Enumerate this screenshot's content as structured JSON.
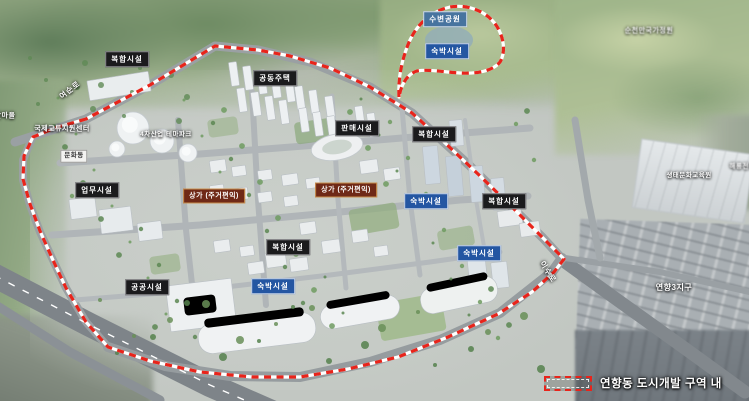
{
  "map": {
    "title": "연향동 도시개발 조감도",
    "labels": [
      {
        "name": "label-mixed-use-nw",
        "text": "복합시설",
        "type": "dark",
        "x": 127,
        "y": 59
      },
      {
        "name": "label-apartments",
        "text": "공동주택",
        "type": "dark",
        "x": 275,
        "y": 78
      },
      {
        "name": "label-retail",
        "text": "판매시설",
        "type": "dark",
        "x": 357,
        "y": 128
      },
      {
        "name": "label-mixed-use-ne",
        "text": "복합시설",
        "type": "dark",
        "x": 434,
        "y": 134
      },
      {
        "name": "label-office",
        "text": "업무시설",
        "type": "dark",
        "x": 97,
        "y": 190
      },
      {
        "name": "label-mixed-use-center",
        "text": "복합시설",
        "type": "dark",
        "x": 288,
        "y": 247
      },
      {
        "name": "label-mixed-use-east",
        "text": "복합시설",
        "type": "dark",
        "x": 504,
        "y": 201
      },
      {
        "name": "label-public-facility",
        "text": "공공시설",
        "type": "dark",
        "x": 147,
        "y": 287
      },
      {
        "name": "label-waterside-park",
        "text": "수변공원",
        "type": "park",
        "x": 445,
        "y": 19
      },
      {
        "name": "label-lodging-north",
        "text": "숙박시설",
        "type": "blue",
        "x": 447,
        "y": 51
      },
      {
        "name": "label-lodging-mid",
        "text": "숙박시설",
        "type": "blue",
        "x": 426,
        "y": 201
      },
      {
        "name": "label-lodging-southeast",
        "text": "숙박시설",
        "type": "blue",
        "x": 479,
        "y": 253
      },
      {
        "name": "label-lodging-south",
        "text": "숙박시설",
        "type": "blue",
        "x": 273,
        "y": 286
      },
      {
        "name": "label-shops-west",
        "text": "상가 (주거편익)",
        "type": "shop",
        "x": 214,
        "y": 196
      },
      {
        "name": "label-shops-center",
        "text": "상가 (주거편익)",
        "type": "shop",
        "x": 346,
        "y": 190
      },
      {
        "name": "label-intl-exchange-center",
        "text": "국제교류지원센터",
        "type": "plain",
        "x": 62,
        "y": 129
      },
      {
        "name": "label-4th-industry-themepark",
        "text": "4차산업 테마파크",
        "type": "plain",
        "x": 166,
        "y": 135,
        "fs": 6.5
      },
      {
        "name": "label-culture-hall",
        "text": "문화동",
        "type": "white",
        "x": 74,
        "y": 156
      },
      {
        "name": "label-suncheon-bay-garden",
        "text": "순천만국가정원",
        "type": "plain-blur",
        "x": 649,
        "y": 31
      },
      {
        "name": "label-eco-culture-center",
        "text": "생태문화교육원",
        "type": "plain",
        "x": 689,
        "y": 176,
        "fs": 6.5
      },
      {
        "name": "label-yeonhyang-district3",
        "text": "연향3지구",
        "type": "plain",
        "x": 674,
        "y": 288,
        "fs": 8
      },
      {
        "name": "label-village-west",
        "text": "안마을",
        "type": "plain",
        "x": 5,
        "y": 116
      },
      {
        "name": "label-haeryong-village",
        "text": "해룡전원마을",
        "type": "plain-blur",
        "x": 749,
        "y": 167,
        "fs": 6.5
      },
      {
        "name": "label-road-yeosun-ro",
        "text": "여순로",
        "type": "road",
        "x": 70,
        "y": 90,
        "rot": -38
      },
      {
        "name": "label-road-isu-ro",
        "text": "이수로",
        "type": "road",
        "x": 548,
        "y": 272,
        "rot": 58
      }
    ],
    "boundary_color": "#e8241b",
    "label_colors": {
      "facility_dark": "#1b1b1d",
      "lodging_blue": "#2456a2",
      "waterside_park_blue": "#47749f",
      "shops_maroon": "#6f2917",
      "shops_border": "#c98f4e"
    }
  },
  "legend": {
    "swatch": "red-dashed-development-boundary",
    "label": "연향동 도시개발 구역 내"
  }
}
